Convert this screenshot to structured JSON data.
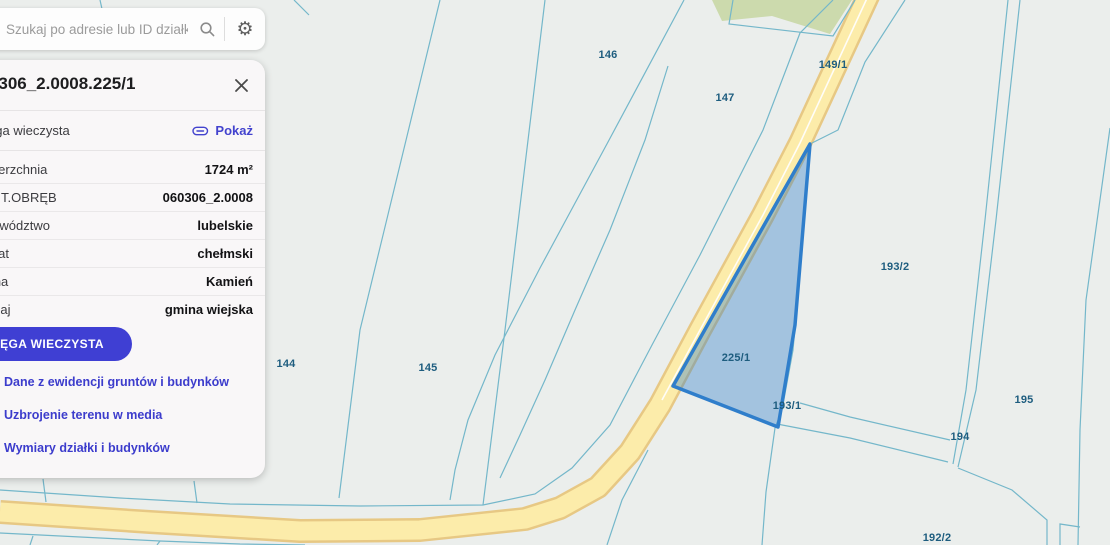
{
  "search_bar": {
    "placeholder": "Szukaj po adresie lub ID działki ...",
    "search_icon": "magnifier",
    "settings_icon": "gear",
    "settings_glyph": "⚙"
  },
  "parcel_panel": {
    "title": "060306_2.0008.225/1",
    "register_row": {
      "label": "Księga wieczysta",
      "action": "Pokaż",
      "action_icon": "paperclip"
    },
    "rows": [
      {
        "label": "Powierzchnia",
        "value": "1724 m²"
      },
      {
        "label": "IDENT.OBRĘB",
        "value": "060306_2.0008"
      },
      {
        "label": "Województwo",
        "value": "lubelskie"
      },
      {
        "label": "Powiat",
        "value": "chełmski"
      },
      {
        "label": "Gmina",
        "value": "Kamień"
      },
      {
        "label": "Rodzaj",
        "value": "gmina wiejska"
      }
    ],
    "primary_button": "KSIĘGA WIECZYSTA",
    "links": [
      "Dane z ewidencji gruntów i budynków",
      "Uzbrojenie terenu w media",
      "Wymiary działki i budynków"
    ]
  },
  "map": {
    "selected_parcel_id": "225/1",
    "labels": [
      {
        "text": "146"
      },
      {
        "text": "147"
      },
      {
        "text": "149/1"
      },
      {
        "text": "193/2"
      },
      {
        "text": "144"
      },
      {
        "text": "145"
      },
      {
        "text": "225/1"
      },
      {
        "text": "193/1"
      },
      {
        "text": "195"
      },
      {
        "text": "194"
      },
      {
        "text": "192/2"
      },
      {
        "text": "148",
        "clipped": true
      },
      {
        "text": "193",
        "clipped": true
      }
    ],
    "colors": {
      "background": "#ebeeec",
      "boundary_line": "#74b7ca",
      "label_text": "#1e5d7f",
      "road_fill": "#fcecaa",
      "road_edge": "#e7c884",
      "forest_fill": "#ccdaad",
      "selected_fill": "rgba(47,126,203,0.38)",
      "selected_border": "#2f7ecb",
      "accent_indigo": "#3f3fd3"
    }
  }
}
